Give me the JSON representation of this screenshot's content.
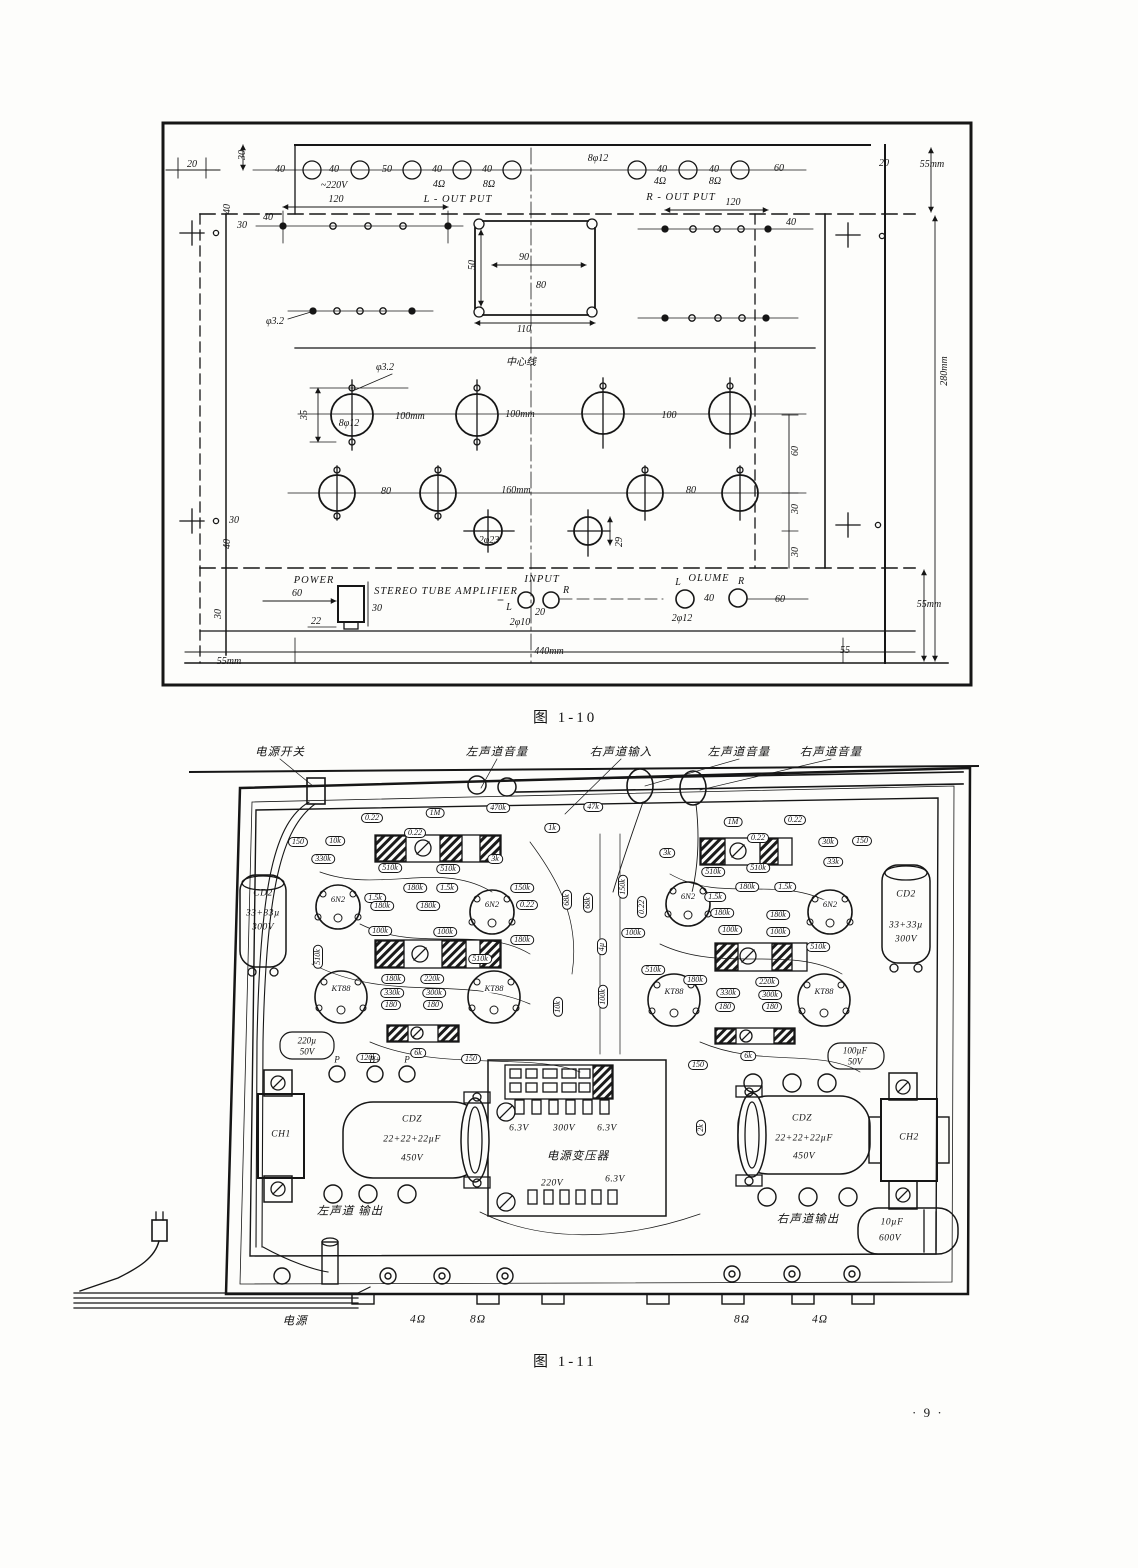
{
  "page": {
    "number": "· 9 ·"
  },
  "f10": {
    "caption": "图  1-10",
    "t": [
      "20",
      "30",
      "40",
      "40",
      "50",
      "40",
      "40",
      "~220V",
      "4Ω",
      "8Ω",
      "8φ12",
      "40",
      "40",
      "60",
      "4Ω",
      "8Ω",
      "20",
      "55mm",
      "L - OUT PUT",
      "R - OUT PUT",
      "40",
      "30",
      "120",
      "40",
      "120",
      "40",
      "φ3.2",
      "50",
      "90",
      "80",
      "110",
      "中心线",
      "φ3.2",
      "35",
      "8φ12",
      "100mm",
      "100mm",
      "100",
      "80",
      "160mm",
      "80",
      "2φ23",
      "29",
      "60",
      "30",
      "30",
      "30",
      "40",
      "280mm",
      "POWER",
      "60",
      "30",
      "22",
      "STEREO TUBE AMPLIFIER",
      "INPUT",
      "L",
      "R",
      "20",
      "2φ10",
      "L",
      "OLUME",
      "R",
      "40",
      "60",
      "2φ12",
      "30",
      "55mm",
      "55mm",
      "440mm",
      "55"
    ]
  },
  "f11": {
    "caption": "图  1-11",
    "t": [
      "电源开关",
      "左声道音量",
      "右声道输入",
      "左声道音量",
      "右声道音量",
      "150",
      "10k",
      "330k",
      "0.22",
      "1M",
      "0.22",
      "470k",
      "1k",
      "47k",
      "510k",
      "510k",
      "3k",
      "1.5k",
      "180k",
      "180k",
      "180k",
      "1.5k",
      "150k",
      "0.22",
      "6N2",
      "6N2",
      "100k",
      "100k",
      "180k",
      "510k",
      "510k",
      "180k",
      "220k",
      "330k",
      "300k",
      "180",
      "180",
      "KT88",
      "KT88",
      "CD2",
      "33+33µ",
      "300V",
      "220µ",
      "50V",
      "120k",
      "6k",
      "150",
      "P",
      "B+",
      "P",
      "68k",
      "68k",
      "4µ",
      "100k",
      "10k",
      "3k",
      "1M",
      "0.22",
      "0.22",
      "30k",
      "150",
      "33k",
      "510k",
      "510k",
      "0.22",
      "150k",
      "1.5k",
      "180k",
      "1.5k",
      "180k",
      "180k",
      "6N2",
      "6N2",
      "100k",
      "100k",
      "100k",
      "510k",
      "510k",
      "180k",
      "220k",
      "330k",
      "300k",
      "180",
      "180",
      "KT88",
      "KT88",
      "CD2",
      "33+33µ",
      "300V",
      "100µF",
      "50V",
      "150",
      "6k",
      "2k",
      "6.3V",
      "300V",
      "6.3V",
      "电源变压器",
      "220V",
      "6.3V",
      "CDZ",
      "22+22+22µF",
      "450V",
      "CH1",
      "左声道 输出",
      "CDZ",
      "22+22+22µF",
      "450V",
      "CH2",
      "右声道输出",
      "10µF",
      "600V",
      "电源",
      "4Ω",
      "8Ω",
      "8Ω",
      "4Ω"
    ]
  }
}
